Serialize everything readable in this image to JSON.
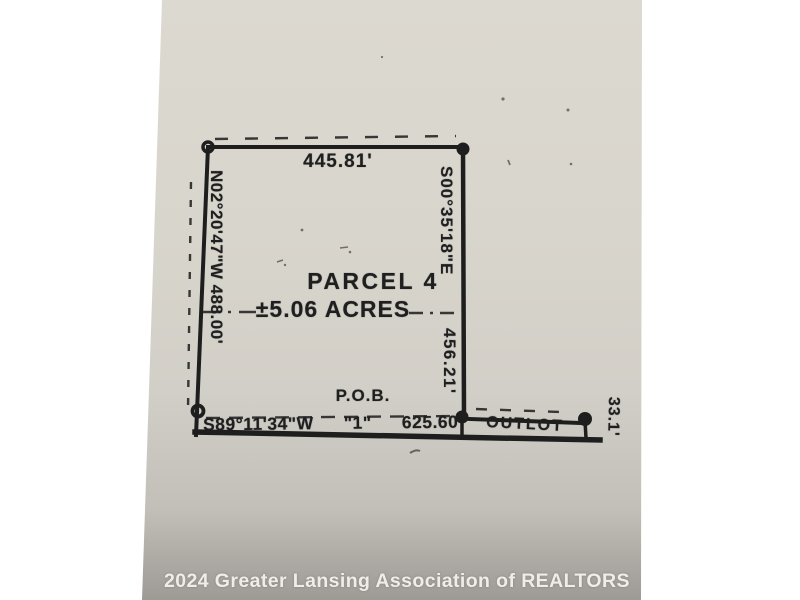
{
  "survey": {
    "parcel": {
      "name": "PARCEL 4",
      "area": "±5.06 ACRES"
    },
    "dimensions": {
      "north_length": "445.81'",
      "west_bearing_length": "N02°20'47\"W 488.00'",
      "east_bearing": "S00°35'18\"E",
      "east_length": "456.21'",
      "south_bearing": "S89°11'34\"W",
      "south_marker": "\"1\"",
      "south_length": "625.60'",
      "outlot_depth": "33.1'"
    },
    "labels": {
      "pob": "P.O.B.",
      "outlot": "OUTLOT"
    }
  },
  "watermark": {
    "text": "2024 Greater Lansing Association of REALTORS"
  },
  "colors": {
    "paper": "#d8d5cc",
    "paper_shadow": "#9e9a95",
    "ink": "#1e1e1e",
    "watermark_text": "#f6f5f1"
  }
}
